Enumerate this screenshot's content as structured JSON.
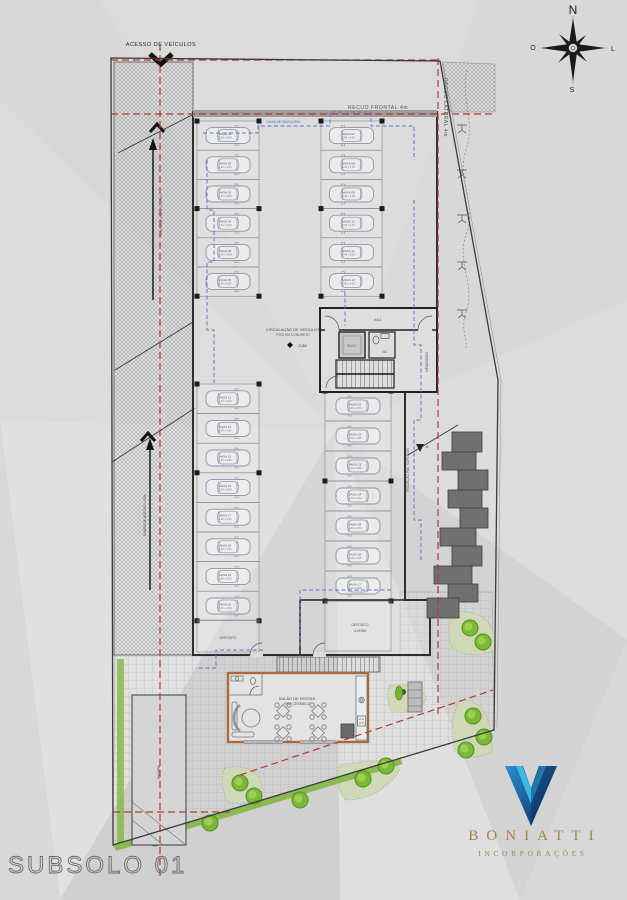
{
  "page": {
    "title": "SUBSOLO 01"
  },
  "compass": {
    "north": "N",
    "south": "S",
    "east": "L",
    "west": "O"
  },
  "site": {
    "access_label": "ACESSO DE VEÍCULOS",
    "front_setback": "RECUO FRONTAL 4m",
    "side_setback": "RECUO LATERAL 4m"
  },
  "ramp": {
    "label": "RAMPA DE ACESSO i=25%",
    "patio_label": "RAMPA"
  },
  "garage": {
    "circulation_line1": "CIRCULAÇÃO DE VEÍCULOS",
    "circulation_line2": "PISO EM CONCRETO",
    "level": "-2,88",
    "utility_label": "CAIXA DE PASSAGEM",
    "projection_label": "PROJEÇÃO PAV. SUPERIOR",
    "section_marker": "A",
    "rooms": {
      "hall": "HALL",
      "elevator": "ELEV.",
      "wc": "WC",
      "meters": "MEDIDORES",
      "storage": "DEPÓSITO",
      "trash": "LIXEIRA"
    },
    "parking": {
      "stall_prefix": "VAGA",
      "stall_dims": "2,40 x 4,50",
      "total_stalls": 27,
      "groups": [
        {
          "name": "upper-left",
          "x": 197,
          "y": 121,
          "w": 62,
          "h": 29.2,
          "count": 6,
          "facing": "left",
          "start": 1
        },
        {
          "name": "upper-right",
          "x": 321,
          "y": 121,
          "w": 61,
          "h": 29.2,
          "count": 6,
          "facing": "right",
          "start": 7
        },
        {
          "name": "lower-left",
          "x": 197,
          "y": 384,
          "w": 62,
          "h": 29.6,
          "count": 8,
          "facing": "left",
          "start": 13
        },
        {
          "name": "lower-right",
          "x": 325,
          "y": 391,
          "w": 66,
          "h": 30,
          "count": 7,
          "facing": "right",
          "start": 21
        }
      ]
    }
  },
  "annex": {
    "party_room_line1": "SALÃO DE FESTAS",
    "party_room_line2": "PISO CERÂMICO"
  },
  "logo": {
    "brand": "BONIATTI",
    "subtitle": "INCORPORAÇÕES"
  },
  "colors": {
    "paper": "#d8d8d8",
    "property_line_red": "#b23a2e",
    "utility_blue": "#5b79c9",
    "vegetation_green": "#7ab838",
    "logo_blue": "#1b6fb5",
    "logo_gold": "#a58245"
  }
}
